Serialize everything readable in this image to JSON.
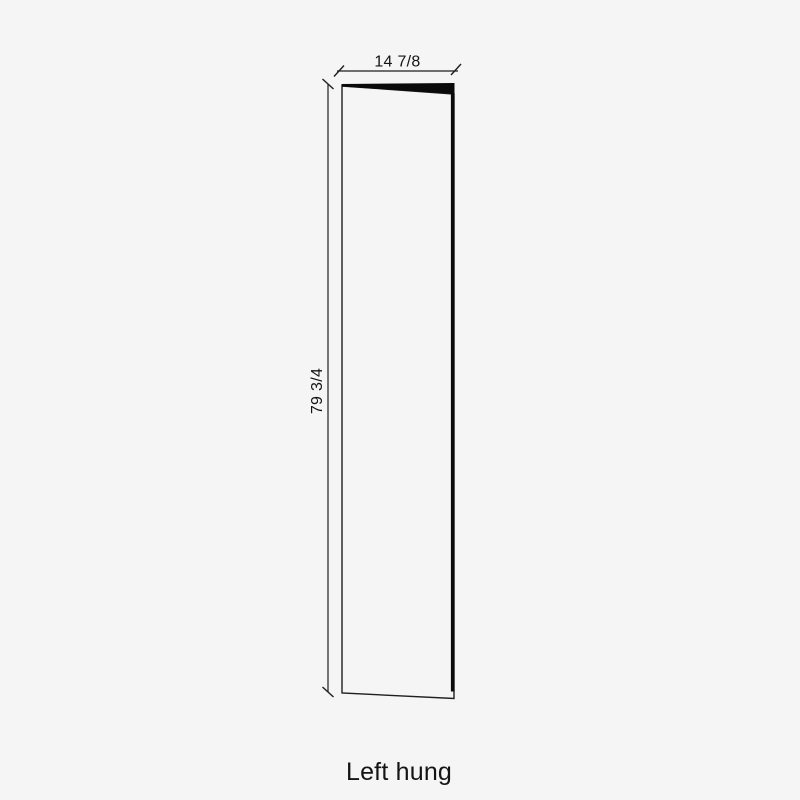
{
  "page": {
    "background_color": "#f5f5f5"
  },
  "diagram": {
    "type": "door-swing-elevation",
    "caption": "Left hung",
    "width_dimension": {
      "label": "14 7/8",
      "orientation": "horizontal"
    },
    "height_dimension": {
      "label": "79 3/4",
      "orientation": "vertical"
    },
    "colors": {
      "line": "#1f1f1f",
      "edge_fill": "#0a0a0a",
      "text": "#141414"
    }
  }
}
